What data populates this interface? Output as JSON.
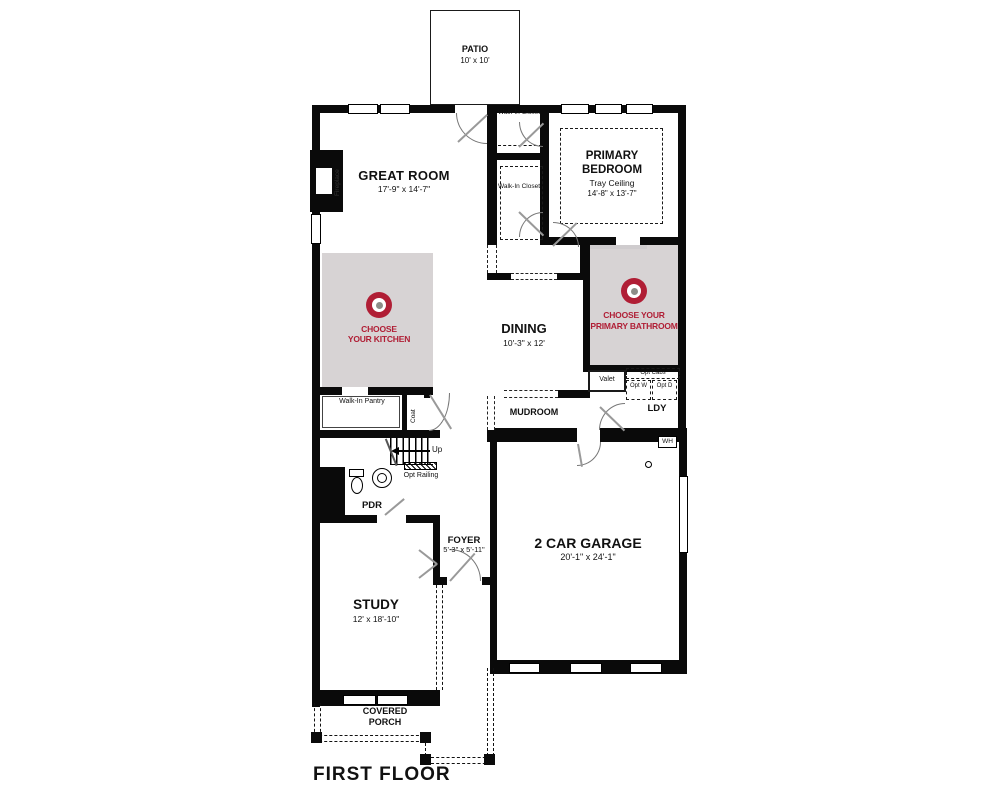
{
  "floor_title": "FIRST FLOOR",
  "colors": {
    "accent_red": "#b01e35",
    "zone_gray": "#d7d3d4",
    "wall_black": "#0a0a0a"
  },
  "rooms": {
    "patio": {
      "name": "PATIO",
      "dims": "10' x 10'"
    },
    "great_room": {
      "name": "GREAT ROOM",
      "dims": "17'-9\" x 14'-7\""
    },
    "walk_in_closet_top": {
      "name": "Walk-In Closet"
    },
    "walk_in_closet_main": {
      "name": "Walk-In Closet"
    },
    "primary_bedroom": {
      "name": "PRIMARY BEDROOM",
      "note": "Tray Ceiling",
      "dims": "14'-8\" x 13'-7\""
    },
    "dining": {
      "name": "DINING",
      "dims": "10'-3\" x 12'"
    },
    "mudroom": {
      "name": "MUDROOM"
    },
    "laundry": {
      "name": "LDY"
    },
    "valet": {
      "name": "Valet"
    },
    "pantry": {
      "name": "Walk-In Pantry"
    },
    "coat": {
      "name": "Coat"
    },
    "powder_room": {
      "name": "PDR"
    },
    "foyer": {
      "name": "FOYER",
      "dims": "5'-3\" x 5'-11\""
    },
    "study": {
      "name": "STUDY",
      "dims": "12' x 18'-10\""
    },
    "garage": {
      "name": "2 CAR GARAGE",
      "dims": "20'-1\" x 24'-1\""
    },
    "covered_porch": {
      "name": "COVERED PORCH"
    },
    "fireplace": {
      "name": "Fireplace"
    }
  },
  "callouts": {
    "kitchen": {
      "line1": "CHOOSE",
      "line2": "YOUR KITCHEN"
    },
    "primary_bath": {
      "line1": "CHOOSE YOUR",
      "line2": "PRIMARY BATHROOM"
    }
  },
  "annotations": {
    "stairs_up": "Up",
    "opt_railing": "Opt Railing",
    "opt_cabs": "Opt Cabs",
    "opt_washer": "Opt W",
    "opt_dryer": "Opt D",
    "water_heater": "WH"
  }
}
